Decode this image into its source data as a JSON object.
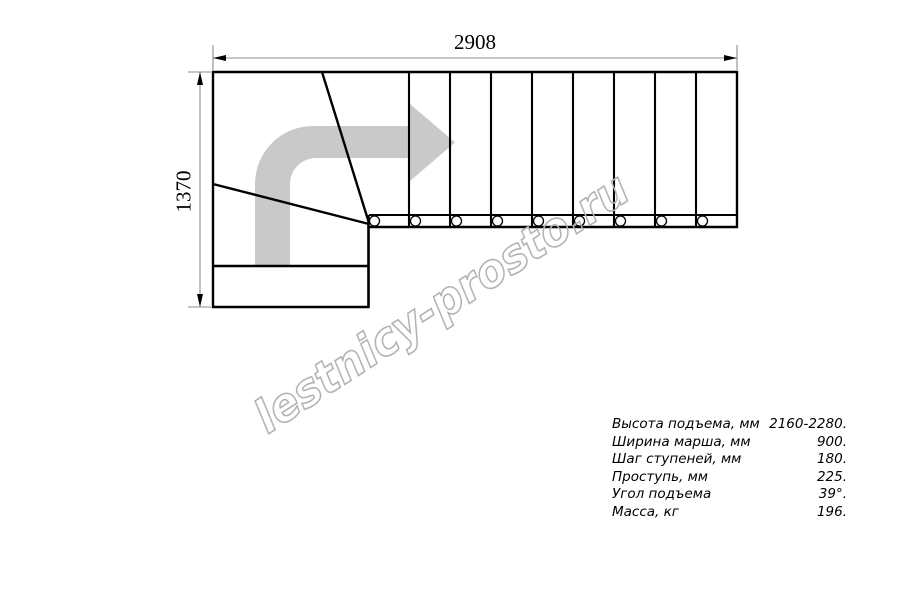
{
  "dimensions": {
    "width_mm": "2908",
    "height_mm": "1370"
  },
  "specs": {
    "rows": [
      {
        "label": "Высота подъема, мм",
        "value": "2160-2280."
      },
      {
        "label": "Ширина марша, мм",
        "value": "900."
      },
      {
        "label": "Шаг ступеней, мм",
        "value": "180."
      },
      {
        "label": "Проступь, мм",
        "value": "225."
      },
      {
        "label": "Угол подъема",
        "value": "39°."
      },
      {
        "label": "Масса, кг",
        "value": "196."
      }
    ]
  },
  "watermark": {
    "text": "lestnicy-prosto.ru"
  },
  "stair_plan": {
    "type": "L-shaped staircase, top view",
    "straight_treads": 9,
    "winder_treads": 3,
    "baluster_holes": 9,
    "direction_arrow": "up-then-right"
  },
  "colors": {
    "background": "#ffffff",
    "line": "#000000",
    "dimension_line": "#8c8c8c",
    "arrow_fill": "#c9c9c9",
    "watermark_stroke": "#b3b3b3"
  }
}
